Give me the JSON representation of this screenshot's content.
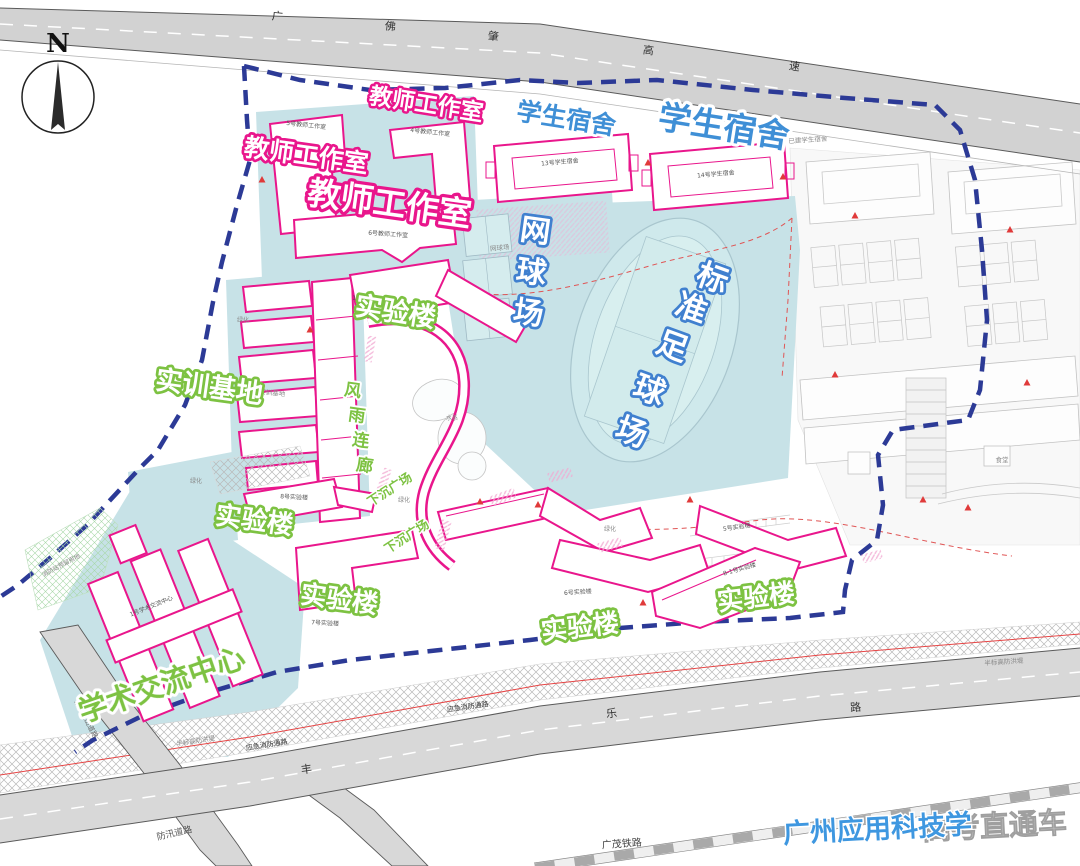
{
  "compass": {
    "n": "N"
  },
  "watermark": {
    "blue": "广州应用科技学",
    "gray": "高考直通车"
  },
  "roads": {
    "highway_chars": [
      "广",
      "佛",
      "肇",
      "高",
      "速"
    ],
    "main_road_chars": [
      "丰",
      "乐",
      "路"
    ],
    "railway": "广茂铁路",
    "mountain_road": "规划进山道路",
    "flood_road": "防汛道路",
    "emergency_road": "应急消防通路",
    "dike": "半标高防洪堤"
  },
  "zones": {
    "teacher_studio": "教师工作室",
    "dorm": "学生宿舍",
    "tennis_chars": [
      "网",
      "球",
      "场"
    ],
    "football_chars": [
      "标",
      "准",
      "足",
      "球",
      "场"
    ],
    "lab": "实验楼",
    "training": "实训基地",
    "corridor_chars": [
      "风",
      "雨",
      "连",
      "廊"
    ],
    "sunken": "下沉广场",
    "academic": "学术交流中心"
  },
  "buildings": {
    "studio5": "5号教师工作室",
    "studio4": "4号教师工作室",
    "studio6": "6号教师工作室",
    "dorm13": "13号学生宿舍",
    "dorm14": "14号学生宿舍",
    "lab1": "1号实验楼",
    "lab5": "5号实验楼",
    "lab6": "6号实验楼",
    "lab7": "7号实验楼",
    "lab8": "8号实验楼",
    "lab81": "8-1号实验楼",
    "academic1": "1号学术交流中心"
  },
  "small_labels": {
    "tennis": "网球场",
    "water": "水系",
    "green": "绿化",
    "existing_dorm": "已建学生宿舍",
    "fire_reserve": "消防站预留用地",
    "training": "实训基地",
    "canteen": "食堂"
  },
  "colors": {
    "pink": "#e9168c",
    "boundary": "#2c3a96",
    "teal": "#c7e2e7",
    "blue_label": "#3f8fd6",
    "green_label": "#7dc242",
    "red": "#e05555"
  }
}
